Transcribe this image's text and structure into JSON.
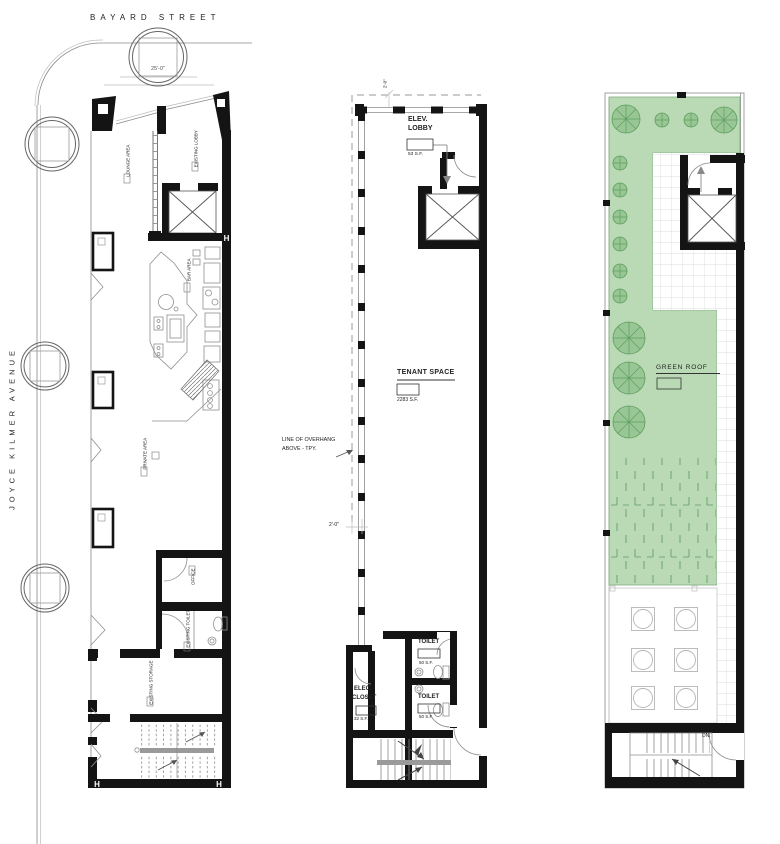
{
  "site": {
    "street_top_label": "BAYARD STREET",
    "street_left_label": "JOYCE KILMER AVENUE",
    "curb_dimension": "25'-0\""
  },
  "ground_floor_plan": {
    "column_mark": "H",
    "labels": {
      "existing_lobby": "EXISTING LOBBY",
      "lounge_area": "LOUNGE AREA",
      "bar_area": "BAR AREA",
      "private_area": "PRIVATE AREA",
      "office": "OFFICE",
      "existing_toilet": "EXISTING TOILET",
      "existing_storage": "EXISTING STORAGE"
    }
  },
  "tenant_floor_plan": {
    "elev_lobby_name_line1": "ELEV.",
    "elev_lobby_name_line2": "LOBBY",
    "elev_lobby_area": "53 S.F.",
    "tenant_space_name": "TENANT SPACE",
    "tenant_space_area": "2283 S.F.",
    "overhang_note_line1": "LINE OF OVERHANG",
    "overhang_note_line2": "ABOVE - TPY.",
    "overhang_offset_dimension": "2'-0\"",
    "top_offset_dimension": "2'-0\"",
    "toilet_name": "TOILET",
    "toilet_area": "50 S.F.",
    "elec_closet_name_line1": "ELEC.",
    "elec_closet_name_line2": "CLOSET",
    "elec_closet_area": "32 S.F."
  },
  "roof_plan": {
    "green_roof_name": "GREEN ROOF",
    "down_stair_label": "DN."
  },
  "colors": {
    "green_fill": "#b9dab5",
    "green_line": "#76a876",
    "tree_fill": "#98c694",
    "wall_black": "#141414",
    "line_gray": "#8a8a8a",
    "grid_gray": "#d4d4d4",
    "text_dark": "#222222"
  }
}
